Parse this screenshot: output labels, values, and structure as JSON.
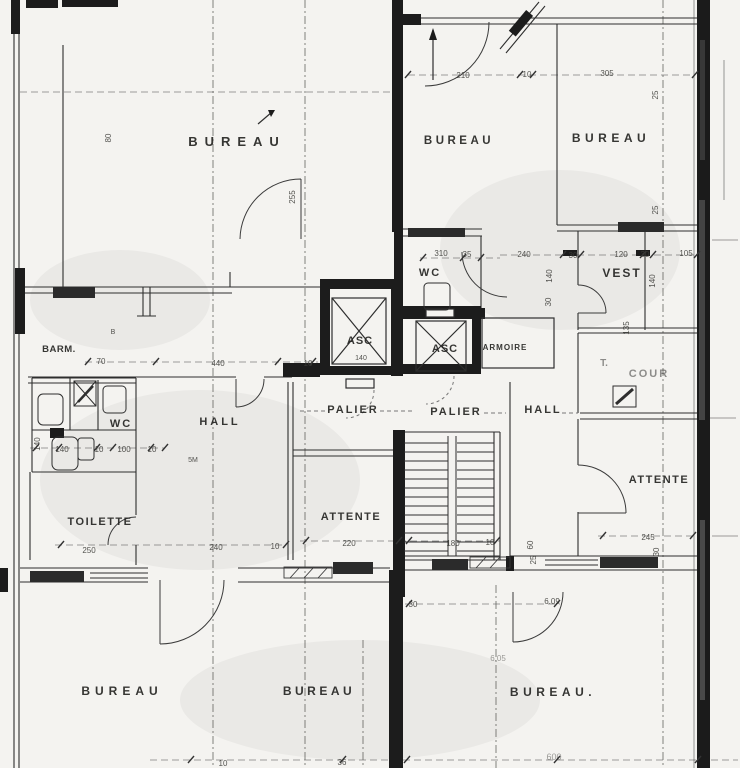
{
  "document": {
    "kind": "scanned-floor-plan"
  },
  "colors": {
    "paper": "#f4f3f0",
    "ink": "#1c1c1c",
    "wall_line": "#2e2e2e",
    "faint": "#8b8b87",
    "grid_dash": "#55544f",
    "window_dark": "#2b2b2b"
  },
  "plan": {
    "rooms": [
      {
        "id": "bureau-top-left",
        "text": "BUREAU",
        "x": 237,
        "y": 146,
        "fs": 13,
        "ls": 7
      },
      {
        "id": "bureau-top-center",
        "text": "BUREAU",
        "x": 459,
        "y": 144,
        "fs": 11.5,
        "ls": 3.5
      },
      {
        "id": "bureau-top-right",
        "text": "BUREAU",
        "x": 611,
        "y": 142,
        "fs": 12,
        "ls": 4.5
      },
      {
        "id": "wc-center",
        "text": "WC",
        "x": 430,
        "y": 276,
        "fs": 11,
        "ls": 2
      },
      {
        "id": "vest",
        "text": "VEST",
        "x": 622,
        "y": 277,
        "fs": 12,
        "ls": 2
      },
      {
        "id": "asc-left",
        "text": "ASC",
        "x": 360,
        "y": 344,
        "fs": 11,
        "ls": 1
      },
      {
        "id": "asc-right",
        "text": "ASC",
        "x": 445,
        "y": 352,
        "fs": 11,
        "ls": 1
      },
      {
        "id": "armoire",
        "text": "ARMOIRE",
        "x": 505,
        "y": 350,
        "fs": 8,
        "ls": 1
      },
      {
        "id": "palier-left",
        "text": "PALIER",
        "x": 353,
        "y": 413,
        "fs": 11,
        "ls": 2
      },
      {
        "id": "palier-right",
        "text": "PALIER",
        "x": 456,
        "y": 415,
        "fs": 11,
        "ls": 2
      },
      {
        "id": "hall-left",
        "text": "HALL",
        "x": 220,
        "y": 425,
        "fs": 11,
        "ls": 3
      },
      {
        "id": "hall-right",
        "text": "HALL",
        "x": 543,
        "y": 413,
        "fs": 11,
        "ls": 2
      },
      {
        "id": "wc-left",
        "text": "WC",
        "x": 121,
        "y": 427,
        "fs": 11,
        "ls": 2
      },
      {
        "id": "barm",
        "text": "BARM.",
        "x": 59,
        "y": 352,
        "fs": 9.5,
        "ls": 0.5
      },
      {
        "id": "toilette",
        "text": "TOILETTE",
        "x": 100,
        "y": 525,
        "fs": 11,
        "ls": 1.5
      },
      {
        "id": "attente-center",
        "text": "ATTENTE",
        "x": 351,
        "y": 520,
        "fs": 11,
        "ls": 1.5
      },
      {
        "id": "attente-right",
        "text": "ATTENTE",
        "x": 659,
        "y": 483,
        "fs": 11,
        "ls": 1.5
      },
      {
        "id": "cour",
        "text": "COUR",
        "x": 649,
        "y": 377,
        "fs": 11,
        "ls": 2,
        "muted": true
      },
      {
        "id": "cour-t",
        "text": "T.",
        "x": 604,
        "y": 366,
        "fs": 10,
        "ls": 0,
        "muted": true
      },
      {
        "id": "bureau-bottom-left",
        "text": "BUREAU",
        "x": 122,
        "y": 695,
        "fs": 12,
        "ls": 5
      },
      {
        "id": "bureau-bottom-center",
        "text": "BUREAU",
        "x": 319,
        "y": 695,
        "fs": 12,
        "ls": 3.5
      },
      {
        "id": "bureau-bottom-right",
        "text": "BUREAU.",
        "x": 553,
        "y": 696,
        "fs": 12,
        "ls": 4.5
      }
    ],
    "dimensions": [
      {
        "text": "210",
        "x": 463,
        "y": 78
      },
      {
        "text": "10",
        "x": 527,
        "y": 77
      },
      {
        "text": "305",
        "x": 607,
        "y": 76
      },
      {
        "text": "80",
        "x": 111,
        "y": 138,
        "rot": -90
      },
      {
        "text": "255",
        "x": 295,
        "y": 197,
        "rot": -90
      },
      {
        "text": "25",
        "x": 658,
        "y": 95,
        "rot": -90
      },
      {
        "text": "25",
        "x": 658,
        "y": 210,
        "rot": -90
      },
      {
        "text": "310",
        "x": 441,
        "y": 256
      },
      {
        "text": "35",
        "x": 467,
        "y": 257
      },
      {
        "text": "240",
        "x": 524,
        "y": 257
      },
      {
        "text": "30",
        "x": 573,
        "y": 258
      },
      {
        "text": "120",
        "x": 621,
        "y": 257
      },
      {
        "text": "30",
        "x": 645,
        "y": 257
      },
      {
        "text": "105",
        "x": 686,
        "y": 256
      },
      {
        "text": "140",
        "x": 552,
        "y": 276,
        "rot": -90
      },
      {
        "text": "30",
        "x": 551,
        "y": 302,
        "rot": -90
      },
      {
        "text": "140",
        "x": 655,
        "y": 281,
        "rot": -90
      },
      {
        "text": "135",
        "x": 629,
        "y": 328,
        "rot": -90
      },
      {
        "text": "70",
        "x": 101,
        "y": 364
      },
      {
        "text": "440",
        "x": 218,
        "y": 366
      },
      {
        "text": "10",
        "x": 308,
        "y": 366
      },
      {
        "text": "140",
        "x": 361,
        "y": 360,
        "fs": 7
      },
      {
        "text": "B",
        "x": 113,
        "y": 334,
        "fs": 7
      },
      {
        "text": "140",
        "x": 40,
        "y": 444,
        "rot": -90
      },
      {
        "text": "140",
        "x": 62,
        "y": 452
      },
      {
        "text": "10",
        "x": 99,
        "y": 452
      },
      {
        "text": "100",
        "x": 124,
        "y": 452
      },
      {
        "text": "10",
        "x": 152,
        "y": 452
      },
      {
        "text": "5M",
        "x": 193,
        "y": 462,
        "fs": 7
      },
      {
        "text": "250",
        "x": 89,
        "y": 553
      },
      {
        "text": "240",
        "x": 216,
        "y": 550
      },
      {
        "text": "10",
        "x": 275,
        "y": 549
      },
      {
        "text": "220",
        "x": 349,
        "y": 546
      },
      {
        "text": "180",
        "x": 453,
        "y": 546
      },
      {
        "text": "10",
        "x": 490,
        "y": 545
      },
      {
        "text": "245",
        "x": 648,
        "y": 540
      },
      {
        "text": "30",
        "x": 659,
        "y": 552,
        "rot": -90
      },
      {
        "text": "60",
        "x": 533,
        "y": 545,
        "rot": -90
      },
      {
        "text": "25",
        "x": 536,
        "y": 560,
        "rot": -90
      },
      {
        "text": "6.09",
        "x": 552,
        "y": 604
      },
      {
        "text": "30",
        "x": 413,
        "y": 607
      },
      {
        "text": "6.05",
        "x": 498,
        "y": 661,
        "muted": true
      },
      {
        "text": "10",
        "x": 223,
        "y": 766
      },
      {
        "text": "36",
        "x": 342,
        "y": 765
      },
      {
        "text": "600",
        "x": 554,
        "y": 760,
        "fs": 9,
        "muted": true
      }
    ]
  }
}
